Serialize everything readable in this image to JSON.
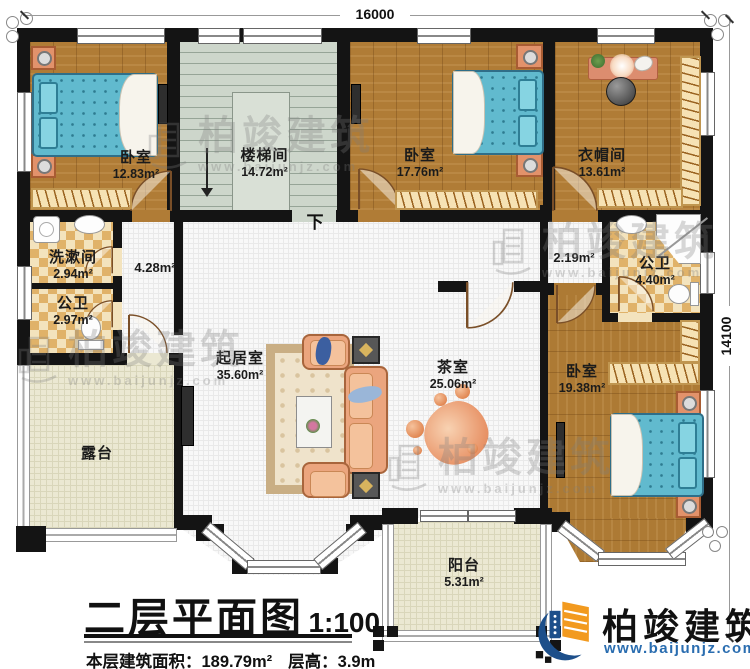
{
  "dimensions": {
    "top": "16000",
    "right": "14100"
  },
  "rooms": {
    "bedroom1": {
      "name": "卧室",
      "area": "12.83m²"
    },
    "stairwell": {
      "name": "楼梯间",
      "area": "14.72m²"
    },
    "bedroom2": {
      "name": "卧室",
      "area": "17.76m²"
    },
    "cloakroom": {
      "name": "衣帽间",
      "area": "13.61m²"
    },
    "washroom": {
      "name": "洗漱间",
      "area": "2.94m²"
    },
    "toilet_small": {
      "name": "公卫",
      "area": "2.97m²"
    },
    "toilet_large": {
      "name": "公卫",
      "area": "4.40m²"
    },
    "hall_west": {
      "area": "4.28m²"
    },
    "hall_east": {
      "area": "2.19m²"
    },
    "living": {
      "name": "起居室",
      "area": "35.60m²"
    },
    "tea": {
      "name": "茶室",
      "area": "25.06m²"
    },
    "bedroom3": {
      "name": "卧室",
      "area": "19.38m²"
    },
    "terrace": {
      "name": "露台"
    },
    "balcony": {
      "name": "阳台",
      "area": "5.31m²"
    }
  },
  "stairs": {
    "direction_label": "下"
  },
  "title": {
    "main": "二层平面图",
    "scale": "1:100",
    "area_label": "本层建筑面积：",
    "area_value": "189.79m²",
    "height_label": "层高：",
    "height_value": "3.9m"
  },
  "brand": {
    "name": "柏竣建筑",
    "url": "www.baijunjz.com"
  },
  "watermark": {
    "name": "柏竣建筑",
    "url": "www.baijunjz.com"
  },
  "colors": {
    "wall": "#141414",
    "wood": "#b07c36",
    "stair": "#cdd6cb",
    "tile_light": "#f3e3bd",
    "tile_dark": "#e0b269",
    "outdoor": "#ebe8d2",
    "bed": "#61bace",
    "sofa": "#eba57e",
    "brand_blue": "#2a6db0"
  }
}
